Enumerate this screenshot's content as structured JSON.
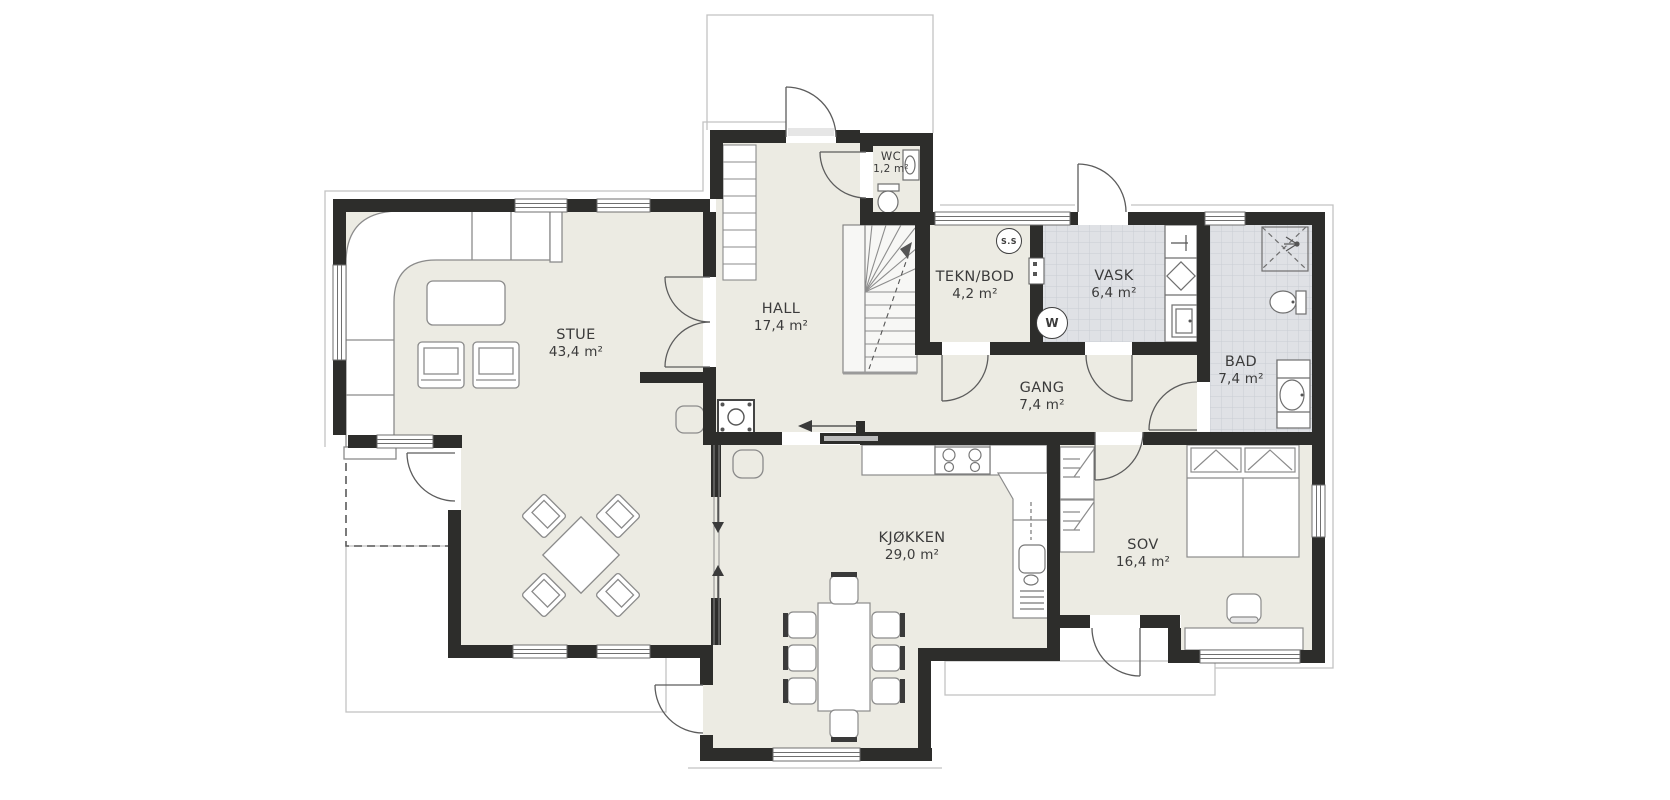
{
  "plan": {
    "rooms": [
      {
        "name": "STUE",
        "area": "43,4 m²"
      },
      {
        "name": "HALL",
        "area": "17,4 m²"
      },
      {
        "name": "WC",
        "area": "1,2 m²"
      },
      {
        "name": "TEKN/BOD",
        "area": "4,2 m²"
      },
      {
        "name": "VASK",
        "area": "6,4 m²"
      },
      {
        "name": "BAD",
        "area": "7,4 m²"
      },
      {
        "name": "GANG",
        "area": "7,4 m²"
      },
      {
        "name": "KJØKKEN",
        "area": "29,0 m²"
      },
      {
        "name": "SOV",
        "area": "16,4 m²"
      }
    ],
    "symbols": {
      "shower_socket": "S.S",
      "washing_machine": "W"
    },
    "colors": {
      "wall": "#2d2d2b",
      "floor": "#ecebe3",
      "tile": "#dfe1e5",
      "furniture_line": "#8b8b8b"
    }
  }
}
